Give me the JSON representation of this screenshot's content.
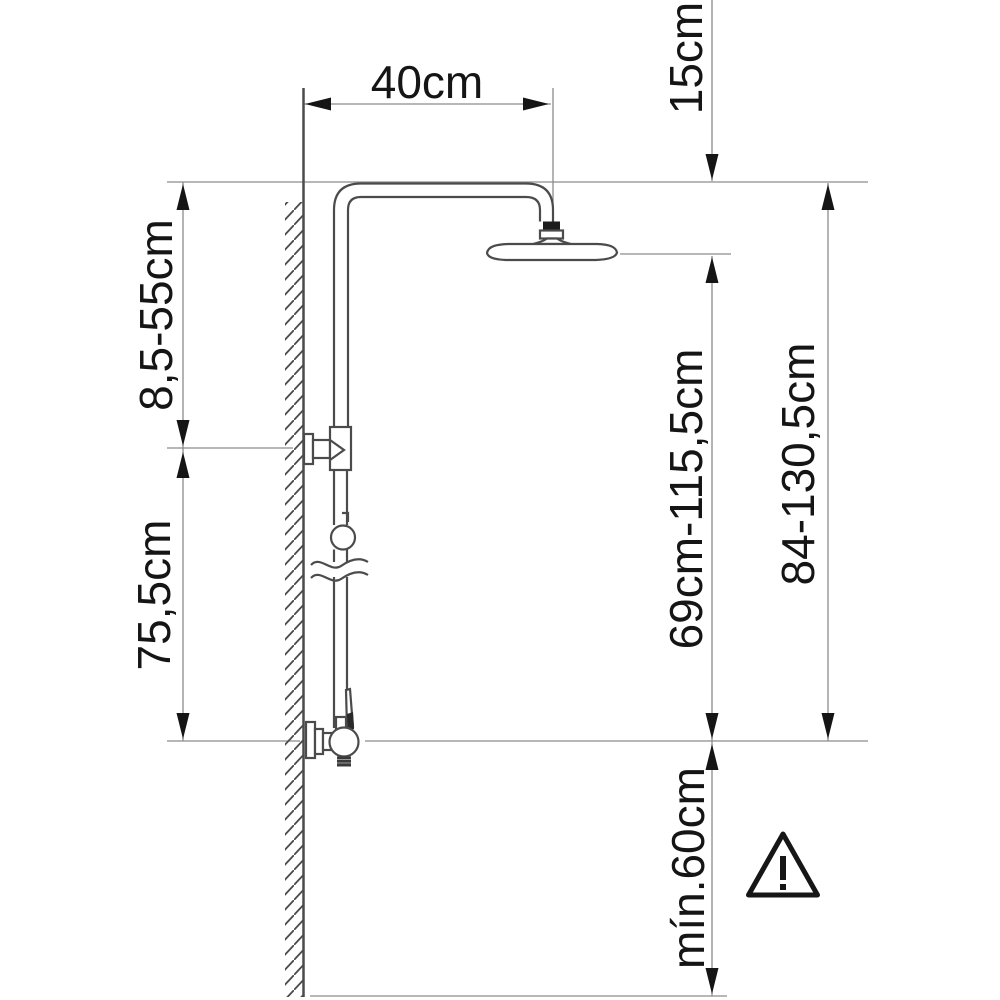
{
  "dimension_labels": {
    "arm_reach": "40cm",
    "head_offset": "15cm",
    "upper_bracket_range": "8,5-55cm",
    "bracket_to_mixer": "75,5cm",
    "riser_range": "69cm-115,5cm",
    "overall_range": "84-130,5cm",
    "min_clearance": "mín.60cm"
  },
  "icons": {
    "warning_triangle": "!"
  },
  "colors": {
    "background": "#ffffff",
    "object_line": "#4b4b4b",
    "dimension_line": "#8c8c8c",
    "text_and_arrows": "#151515"
  }
}
